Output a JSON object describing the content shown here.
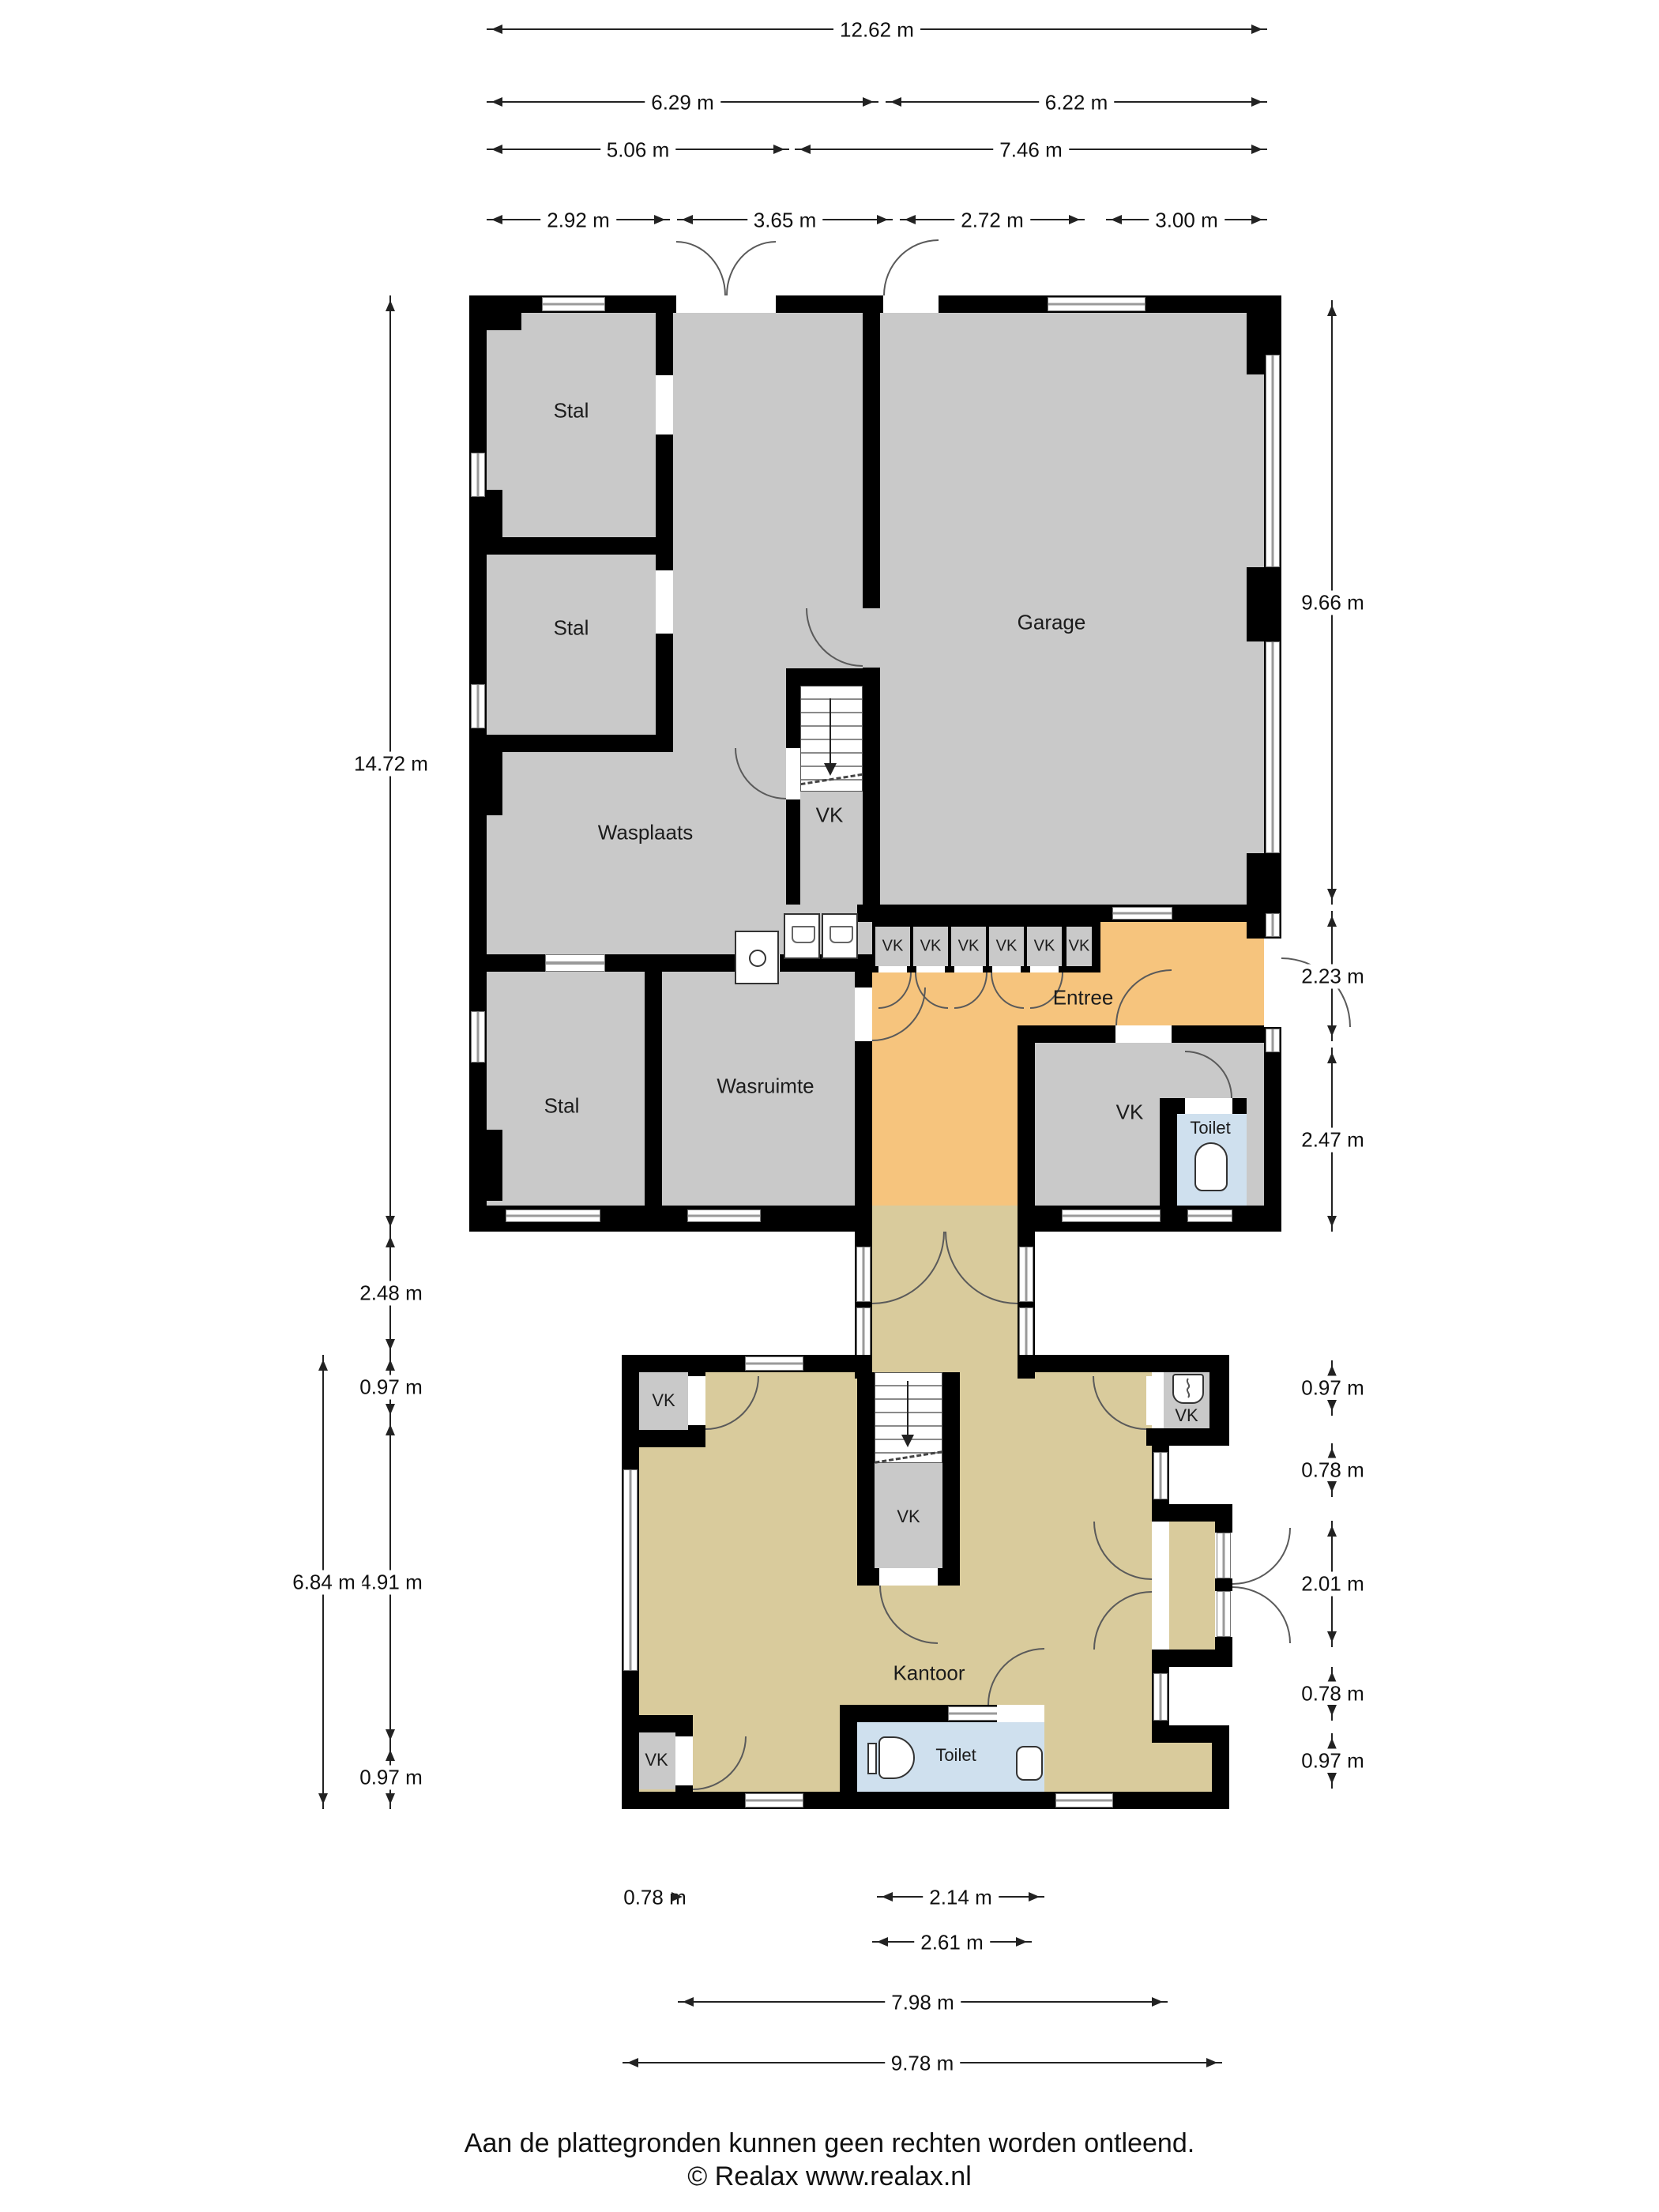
{
  "colors": {
    "wall": "#000000",
    "floor_gray": "#c9c9c9",
    "floor_orange": "#f6c47d",
    "floor_tan": "#d9cb9c",
    "floor_blue": "#cfe0ee"
  },
  "rooms": {
    "stal": "Stal",
    "garage": "Garage",
    "wasplaats": "Wasplaats",
    "wasruimte": "Wasruimte",
    "entree": "Entree",
    "toilet": "Toilet",
    "kantoor": "Kantoor",
    "vk": "VK"
  },
  "dims": {
    "top": [
      "12.62 m",
      "6.29 m",
      "6.22 m",
      "5.06 m",
      "7.46 m",
      "2.92 m",
      "3.65 m",
      "2.72 m",
      "3.00 m"
    ],
    "left": [
      "14.72 m",
      "2.48 m",
      "0.97 m",
      "4.91 m",
      "0.97 m",
      "6.84 m"
    ],
    "right": [
      "9.66 m",
      "2.23 m",
      "2.47 m",
      "0.97 m",
      "0.78 m",
      "2.01 m",
      "0.78 m",
      "0.97 m"
    ],
    "bottom": [
      "0.78 m",
      "2.14 m",
      "2.61 m",
      "7.98 m",
      "9.78 m"
    ]
  },
  "footer": {
    "line1": "Aan de plattegronden kunnen geen rechten worden ontleend.",
    "line2": "© Realax www.realax.nl"
  }
}
